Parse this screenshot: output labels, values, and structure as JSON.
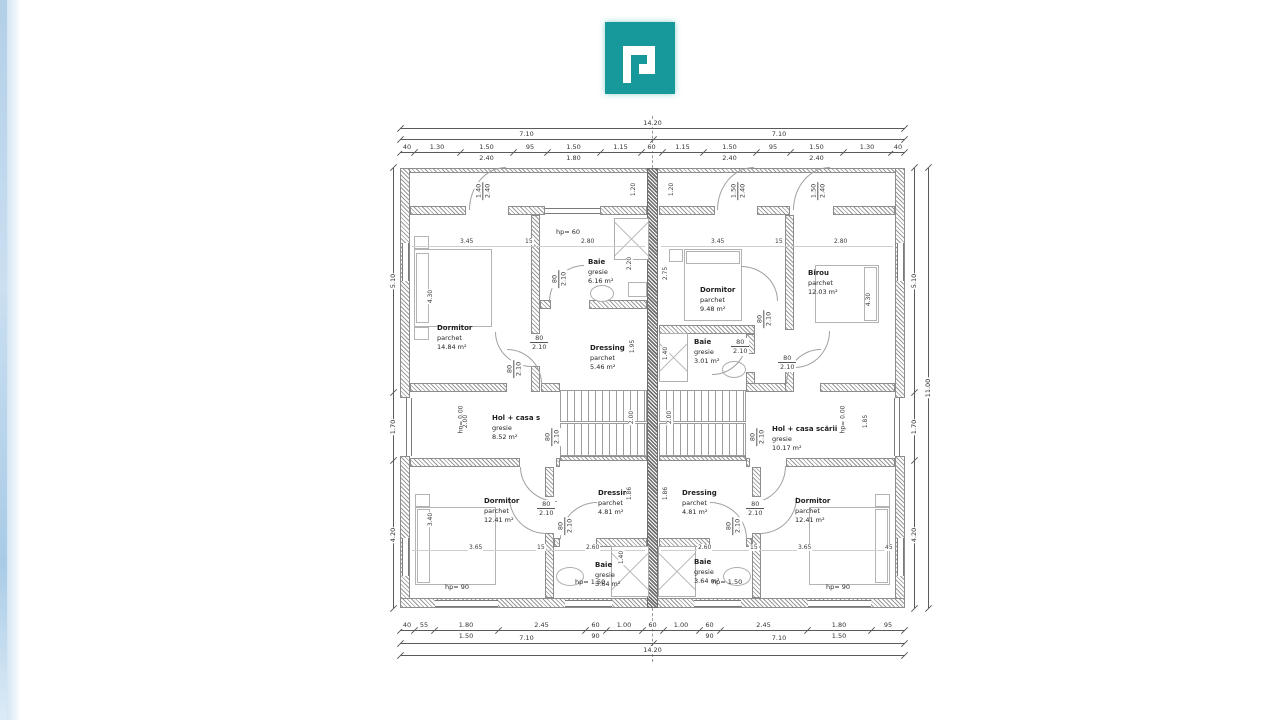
{
  "page": {
    "background": "#ffffff"
  },
  "logo": {
    "color": "#17989a"
  },
  "plan": {
    "units": [
      {
        "side": "left",
        "rooms": [
          {
            "name": "Dormitor",
            "finish": "parchet",
            "area": "14.84 m²"
          },
          {
            "name": "Baie",
            "finish": "gresie",
            "area": "6.16 m²"
          },
          {
            "name": "Dressing",
            "finish": "parchet",
            "area": "5.46 m²"
          },
          {
            "name": "Hol + casa s",
            "finish": "gresie",
            "area": "8.52 m²"
          },
          {
            "name": "Dormitor",
            "finish": "parchet",
            "area": "12.41 m²"
          },
          {
            "name": "Dressing",
            "finish": "parchet",
            "area": "4.81 m²"
          },
          {
            "name": "Baie",
            "finish": "gresie",
            "area": "3.64 m²"
          }
        ]
      },
      {
        "side": "right",
        "rooms": [
          {
            "name": "Dormitor",
            "finish": "parchet",
            "area": "9.48 m²"
          },
          {
            "name": "Birou",
            "finish": "parchet",
            "area": "12.03 m²"
          },
          {
            "name": "Baie",
            "finish": "gresie",
            "area": "3.01 m²"
          },
          {
            "name": "Hol + casa scării",
            "finish": "gresie",
            "area": "10.17 m²"
          },
          {
            "name": "Dressing",
            "finish": "parchet",
            "area": "4.81 m²"
          },
          {
            "name": "Dormitor",
            "finish": "parchet",
            "area": "12.41 m²"
          },
          {
            "name": "Baie",
            "finish": "gresie",
            "area": "3.64 m²"
          }
        ]
      }
    ],
    "door": {
      "w": "80",
      "h": "2.10"
    },
    "windows": {
      "w150": "1.50",
      "w140": "1.40",
      "h240": "2.40",
      "v120": "1.20"
    },
    "notes": {
      "hp60": "hp= 60",
      "hp90": "hp= 90",
      "hp150": "hp= 1.50",
      "hp0": "hp= 0.00",
      "n200": "2.00",
      "n185": "1.85"
    },
    "interior": {
      "a345": "3.45",
      "a15": "15",
      "a280": "2.80",
      "v430": "4.30",
      "v220": "2.20",
      "v195": "1.95",
      "v275": "2.75",
      "v140": "1.40",
      "v340": "3.40",
      "v186": "1.86",
      "b365": "3.65",
      "b260": "2.60",
      "b45": "45",
      "s200": "2.00"
    },
    "dims": {
      "top": {
        "overall": "14.20",
        "half": "7.10",
        "segments": [
          "40",
          "1.30",
          "1.50",
          "95",
          "1.50",
          "1.15",
          "60",
          "1.15",
          "1.50",
          "95",
          "1.50",
          "1.30",
          "40"
        ],
        "subs": {
          "2": "2.40",
          "4": "1.80",
          "8": "2.40",
          "10": "2.40"
        }
      },
      "bottom": {
        "overall": "14.20",
        "half": "7.10",
        "segments": [
          "40",
          "55",
          "1.80",
          "2.45",
          "60",
          "1.00",
          "60",
          "1.00",
          "60",
          "2.45",
          "1.80",
          "95"
        ],
        "subs": {
          "2": "1.50",
          "4": "90",
          "8": "90",
          "10": "1.50"
        }
      },
      "left": [
        "5.10",
        "1.70",
        "4.20"
      ],
      "right": [
        "5.10",
        "1.70",
        "4.20"
      ],
      "right_overall": "11.00"
    }
  }
}
